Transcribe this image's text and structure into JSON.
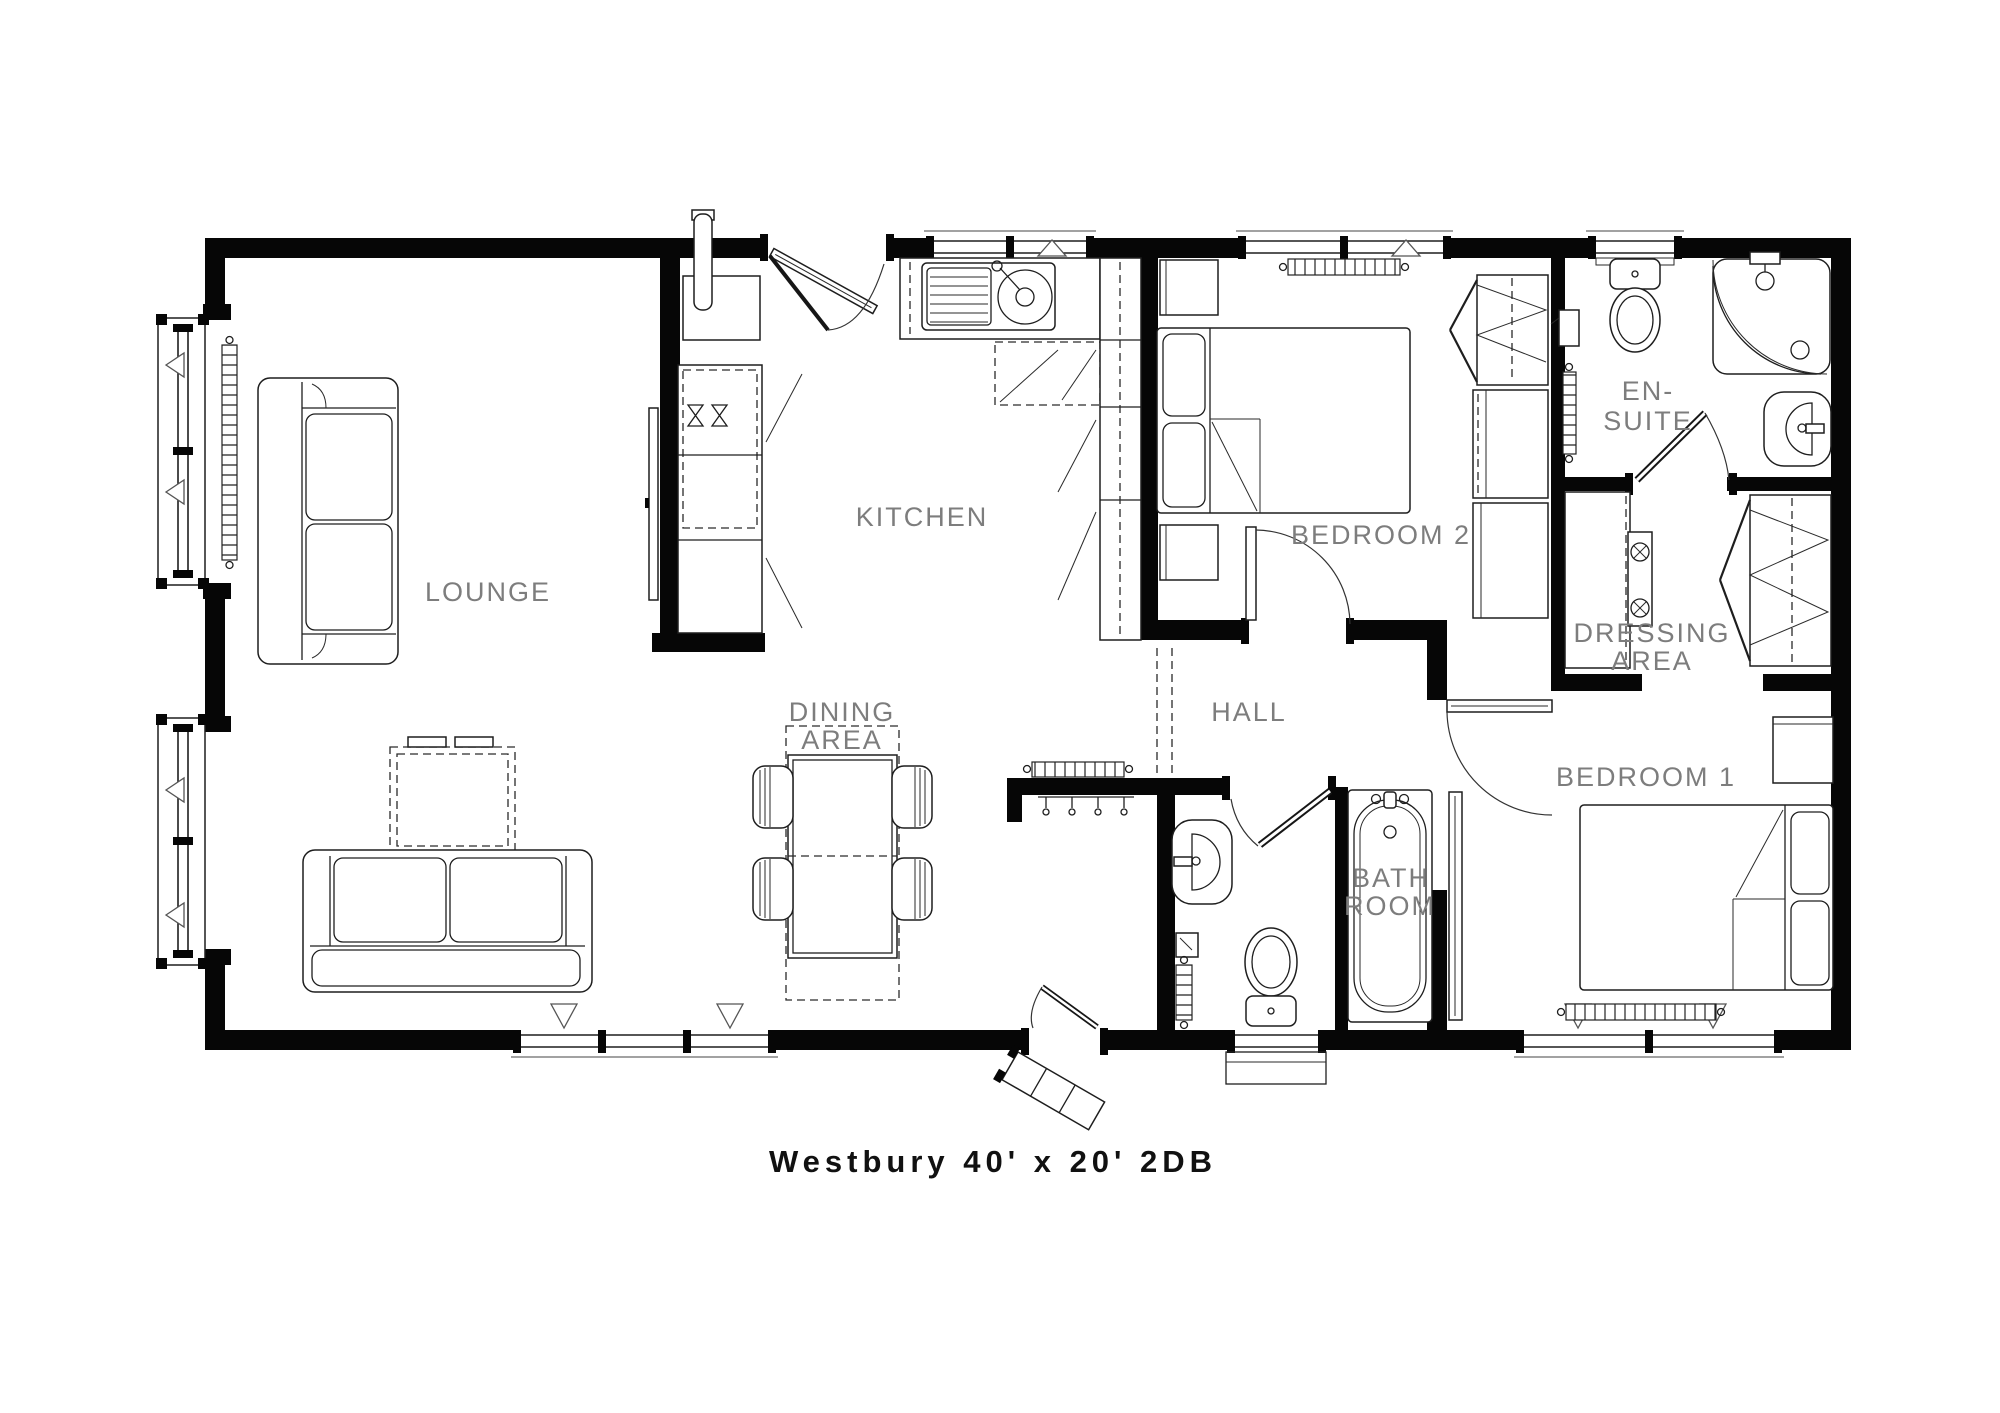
{
  "title": "Westbury 40' x 20' 2DB",
  "rooms": {
    "lounge": {
      "label": "LOUNGE"
    },
    "kitchen": {
      "label": "KITCHEN"
    },
    "dining_area": {
      "line1": "DINING",
      "line2": "AREA"
    },
    "hall": {
      "label": "HALL"
    },
    "bedroom2": {
      "label": "BEDROOM 2"
    },
    "ensuite": {
      "line1": "EN-",
      "line2": "SUITE"
    },
    "dressing_area": {
      "line1": "DRESSING",
      "line2": "AREA"
    },
    "bedroom1": {
      "label": "BEDROOM 1"
    },
    "bathroom": {
      "line1": "BATH",
      "line2": "ROOM"
    }
  },
  "colors": {
    "background": "#ffffff",
    "walls": "#060606",
    "furniture_line": "#1e1e1e",
    "label_text": "#7d7d7d",
    "title_text": "#111111"
  },
  "icons": [
    "sofa-icon",
    "coffee-table-icon",
    "tv-unit-icon",
    "radiator-icon",
    "bay-window-icon",
    "dining-table-icon",
    "chair-icon",
    "kitchen-sink-icon",
    "counter-icon",
    "boiler-cupboard-icon",
    "bed-icon",
    "bedside-cabinet-icon",
    "wardrobe-icon",
    "dressing-table-icon",
    "toilet-icon",
    "shower-icon",
    "basin-icon",
    "bath-icon",
    "towel-rail-icon",
    "door-icon",
    "window-icon",
    "steps-icon",
    "coat-hooks-icon"
  ]
}
